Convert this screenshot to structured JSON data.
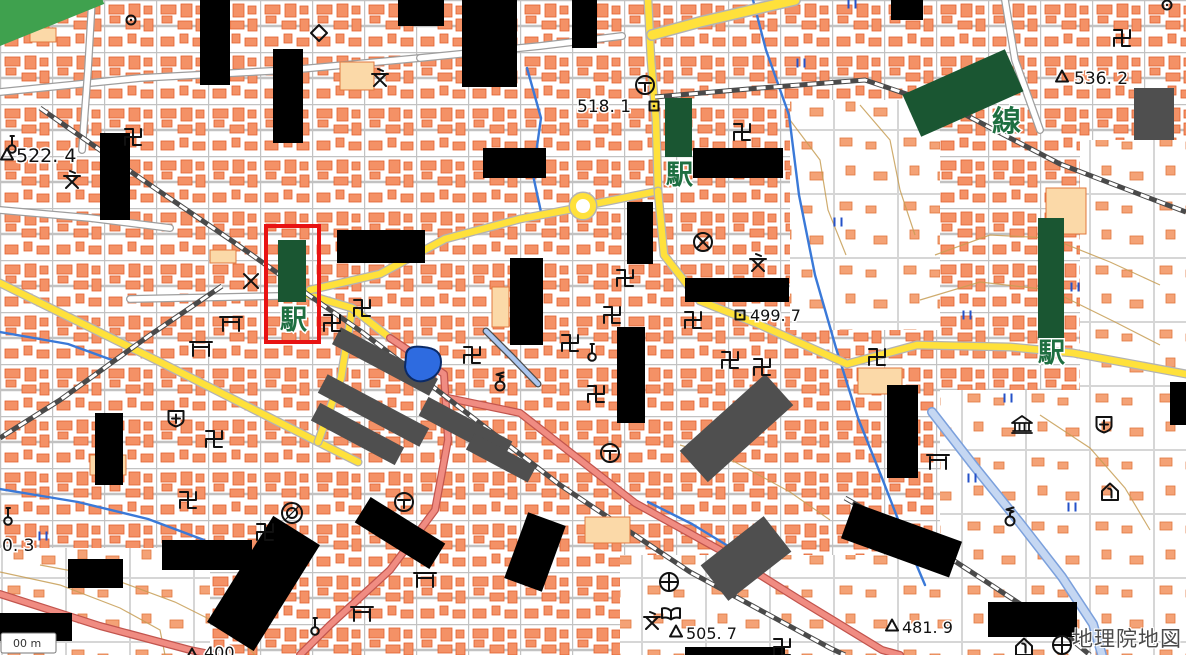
{
  "app": {
    "watermark": "地理院地図",
    "scalebar_text": "00 m"
  },
  "colors": {
    "building": "#f49166",
    "building_edge": "#e2602e",
    "pale_building": "#fbd9a8",
    "yellow_road": "#ffe13b",
    "national_route": "#f08c82",
    "water": "#3a79d8",
    "redaction": "#000000",
    "station_green": "#1a5632",
    "highlight_red": "#e81313"
  },
  "map": {
    "underlays": [
      {
        "x": 940,
        "y": 390,
        "w": 246,
        "h": 265
      },
      {
        "x": 620,
        "y": 555,
        "w": 330,
        "h": 100
      },
      {
        "x": 1080,
        "y": 140,
        "w": 106,
        "h": 250
      },
      {
        "x": 0,
        "y": 548,
        "w": 210,
        "h": 107
      },
      {
        "x": 790,
        "y": 100,
        "w": 150,
        "h": 230
      }
    ],
    "paths": [
      {
        "cls": "contour",
        "pts": "935,255 990,235 1050,238 1110,262 1160,285"
      },
      {
        "cls": "contour",
        "pts": "920,300 980,282 1050,290 1115,322 1160,345"
      },
      {
        "cls": "contour",
        "pts": "40,565 110,578 175,602 235,632 255,655"
      },
      {
        "cls": "contour",
        "pts": "0,572 60,585 120,608 160,630 165,655"
      },
      {
        "cls": "contour",
        "pts": "680,445 735,462 790,492 830,520"
      },
      {
        "cls": "contour",
        "pts": "1040,415 1090,448 1125,488 1150,530"
      },
      {
        "cls": "contour",
        "pts": "790,120 820,160 828,210 846,255"
      },
      {
        "cls": "contour",
        "pts": "860,105 890,140 900,190 915,235"
      },
      {
        "cls": "wroad",
        "pts": "0,92 140,78 290,70 420,58"
      },
      {
        "cls": "wroad",
        "pts": "92,0 88,70 82,150"
      },
      {
        "cls": "wroad",
        "pts": "420,58 540,46 622,36"
      },
      {
        "cls": "wroad",
        "pts": "130,299 280,296"
      },
      {
        "cls": "wroad",
        "pts": "0,210 90,218 170,228"
      },
      {
        "cls": "wroad",
        "pts": "1005,0 1015,60 1040,130"
      },
      {
        "cls": "stream",
        "pts": "753,0 766,50 789,115 799,195 815,275 836,348 858,418 882,478 906,540 925,585"
      },
      {
        "cls": "stream",
        "pts": "527,68 541,118 533,175 541,212"
      },
      {
        "cls": "stream",
        "pts": "0,332 68,344 112,360"
      },
      {
        "cls": "stream",
        "pts": "0,489 78,502 148,519 204,540"
      },
      {
        "cls": "stream",
        "pts": "648,502 692,524 733,549 762,568"
      },
      {
        "cls": "canal",
        "pts": "486,331 512,357 538,384"
      },
      {
        "cls": "riverw",
        "pts": "932,412 974,466 1020,523 1062,577 1093,624 1102,655"
      },
      {
        "cls": "yellow",
        "pts": "0,283 160,362 318,442 358,462"
      },
      {
        "cls": "yellow",
        "pts": "352,310 341,378 318,442"
      },
      {
        "cls": "yellow",
        "pts": "308,295 352,308 390,338"
      },
      {
        "cls": "yellow",
        "pts": "310,290 380,274 445,239 520,219 572,209"
      },
      {
        "cls": "yellow",
        "pts": "594,204 658,191"
      },
      {
        "cls": "yellow",
        "pts": "648,0 651,60 656,120 658,191"
      },
      {
        "cls": "yellow",
        "pts": "658,191 664,255 700,301 758,324 847,364 917,345 1010,347 1073,353 1186,374"
      },
      {
        "cls": "yellowwide",
        "pts": "652,35 700,22 795,0"
      },
      {
        "cls": "pink",
        "pts": "390,338 444,374 448,440 435,510 390,570 330,625 300,655"
      },
      {
        "cls": "pink",
        "pts": "448,398 520,413 580,460 635,503 720,550 800,600 882,650 900,655"
      },
      {
        "cls": "pink",
        "pts": "0,594 100,626 190,650 215,655"
      },
      {
        "cls": "rail",
        "pts": "40,108 140,178 235,243 320,303 362,332"
      },
      {
        "cls": "rail",
        "pts": "222,286 150,335 60,400 0,438"
      },
      {
        "cls": "rail",
        "pts": "655,97 760,88 865,80 960,112 1060,164 1186,212"
      },
      {
        "cls": "rail",
        "pts": "362,332 450,400 560,485 690,572 830,648 845,655"
      },
      {
        "cls": "rail",
        "pts": "845,498 950,558 1060,630 1090,655"
      },
      {
        "cls": "stripe",
        "pts": "0,26 78,-6"
      }
    ],
    "pale_buildings": [
      {
        "x": 340,
        "y": 62,
        "w": 34,
        "h": 28
      },
      {
        "x": 1046,
        "y": 188,
        "w": 40,
        "h": 46
      },
      {
        "x": 858,
        "y": 368,
        "w": 44,
        "h": 26
      },
      {
        "x": 585,
        "y": 517,
        "w": 45,
        "h": 26
      },
      {
        "x": 30,
        "y": 28,
        "w": 26,
        "h": 14
      },
      {
        "x": 90,
        "y": 455,
        "w": 36,
        "h": 20
      },
      {
        "x": 210,
        "y": 250,
        "w": 26,
        "h": 13
      },
      {
        "x": 492,
        "y": 287,
        "w": 17,
        "h": 40
      }
    ],
    "gray_boxes": [
      {
        "x": 330,
        "y": 352,
        "w": 110,
        "h": 19,
        "r": 28
      },
      {
        "x": 316,
        "y": 400,
        "w": 115,
        "h": 21,
        "r": 28
      },
      {
        "x": 310,
        "y": 424,
        "w": 95,
        "h": 20,
        "r": 28
      },
      {
        "x": 418,
        "y": 418,
        "w": 95,
        "h": 21,
        "r": 28
      },
      {
        "x": 466,
        "y": 449,
        "w": 70,
        "h": 18,
        "r": 28
      },
      {
        "x": 679,
        "y": 407,
        "w": 115,
        "h": 42,
        "r": -42
      },
      {
        "x": 706,
        "y": 536,
        "w": 80,
        "h": 45,
        "r": -38
      },
      {
        "x": 1134,
        "y": 88,
        "w": 40,
        "h": 52,
        "r": 0
      }
    ],
    "black_boxes": [
      {
        "x": 200,
        "y": 0,
        "w": 30,
        "h": 85
      },
      {
        "x": 273,
        "y": 49,
        "w": 30,
        "h": 94
      },
      {
        "x": 100,
        "y": 133,
        "w": 30,
        "h": 87
      },
      {
        "x": 398,
        "y": 0,
        "w": 46,
        "h": 26
      },
      {
        "x": 462,
        "y": 0,
        "w": 55,
        "h": 87
      },
      {
        "x": 572,
        "y": 0,
        "w": 25,
        "h": 48
      },
      {
        "x": 483,
        "y": 148,
        "w": 63,
        "h": 30
      },
      {
        "x": 693,
        "y": 148,
        "w": 90,
        "h": 30
      },
      {
        "x": 337,
        "y": 230,
        "w": 88,
        "h": 33
      },
      {
        "x": 510,
        "y": 258,
        "w": 33,
        "h": 87
      },
      {
        "x": 627,
        "y": 202,
        "w": 26,
        "h": 62
      },
      {
        "x": 617,
        "y": 327,
        "w": 28,
        "h": 96
      },
      {
        "x": 685,
        "y": 278,
        "w": 104,
        "h": 24
      },
      {
        "x": 887,
        "y": 385,
        "w": 31,
        "h": 93
      },
      {
        "x": 95,
        "y": 413,
        "w": 28,
        "h": 72
      },
      {
        "x": 162,
        "y": 540,
        "w": 90,
        "h": 30
      },
      {
        "x": 68,
        "y": 559,
        "w": 55,
        "h": 29
      },
      {
        "x": 0,
        "y": 613,
        "w": 72,
        "h": 28
      },
      {
        "x": 891,
        "y": 0,
        "w": 32,
        "h": 20
      },
      {
        "x": 1170,
        "y": 382,
        "w": 16,
        "h": 43
      },
      {
        "x": 685,
        "y": 647,
        "w": 100,
        "h": 8
      },
      {
        "x": 988,
        "y": 602,
        "w": 89,
        "h": 35
      },
      {
        "x": 356,
        "y": 518,
        "w": 88,
        "h": 30,
        "r": 32
      },
      {
        "x": 236,
        "y": 521,
        "w": 55,
        "h": 125,
        "r": 32
      },
      {
        "x": 515,
        "y": 517,
        "w": 40,
        "h": 70,
        "r": 20
      },
      {
        "x": 844,
        "y": 521,
        "w": 115,
        "h": 38,
        "r": 20
      }
    ],
    "green_boxes": [
      {
        "x": 278,
        "y": 240,
        "w": 28,
        "h": 62
      },
      {
        "x": 665,
        "y": 98,
        "w": 27,
        "h": 59
      },
      {
        "x": 1038,
        "y": 218,
        "w": 26,
        "h": 122
      },
      {
        "x": 907,
        "y": 70,
        "w": 112,
        "h": 46,
        "r": -24
      }
    ],
    "green_band": {
      "x": -30,
      "y": -18,
      "w": 130,
      "h": 48,
      "r": -22
    },
    "red_box": {
      "x": 266,
      "y": 226,
      "w": 53,
      "h": 116
    },
    "pond_path": "M406,356 C406,346 416,346 423,347 C436,348 441,353 441,362 C441,373 433,379 424,381 C414,383 406,376 405,367 Z",
    "roundabout": {
      "x": 583,
      "y": 206,
      "r": 10
    },
    "scalebar": {
      "x": 1,
      "y": 633,
      "w": 55,
      "h": 20
    },
    "symbols": [
      {
        "t": "temple",
        "x": 133,
        "y": 137
      },
      {
        "t": "temple",
        "x": 742,
        "y": 132
      },
      {
        "t": "temple",
        "x": 362,
        "y": 308
      },
      {
        "t": "temple",
        "x": 332,
        "y": 323
      },
      {
        "t": "temple",
        "x": 472,
        "y": 355
      },
      {
        "t": "temple",
        "x": 570,
        "y": 343
      },
      {
        "t": "temple",
        "x": 877,
        "y": 357
      },
      {
        "t": "temple",
        "x": 214,
        "y": 439
      },
      {
        "t": "temple",
        "x": 625,
        "y": 278
      },
      {
        "t": "temple",
        "x": 612,
        "y": 315
      },
      {
        "t": "temple",
        "x": 693,
        "y": 320
      },
      {
        "t": "temple",
        "x": 730,
        "y": 360
      },
      {
        "t": "temple",
        "x": 762,
        "y": 367
      },
      {
        "t": "temple",
        "x": 596,
        "y": 394
      },
      {
        "t": "temple",
        "x": 188,
        "y": 500
      },
      {
        "t": "temple",
        "x": 265,
        "y": 532
      },
      {
        "t": "temple",
        "x": 782,
        "y": 647
      },
      {
        "t": "temple",
        "x": 1122,
        "y": 38
      },
      {
        "t": "torii",
        "x": 231,
        "y": 322
      },
      {
        "t": "torii",
        "x": 201,
        "y": 347
      },
      {
        "t": "torii",
        "x": 362,
        "y": 612
      },
      {
        "t": "torii",
        "x": 938,
        "y": 460
      },
      {
        "t": "torii",
        "x": 425,
        "y": 578
      },
      {
        "t": "school",
        "x": 72,
        "y": 180
      },
      {
        "t": "school",
        "x": 380,
        "y": 78
      },
      {
        "t": "school",
        "x": 758,
        "y": 263
      },
      {
        "t": "school",
        "x": 652,
        "y": 621
      },
      {
        "t": "police_x",
        "x": 251,
        "y": 281
      },
      {
        "t": "police_o",
        "x": 703,
        "y": 242
      },
      {
        "t": "cityhall",
        "x": 645,
        "y": 85
      },
      {
        "t": "cityhall",
        "x": 404,
        "y": 502
      },
      {
        "t": "cityhall",
        "x": 610,
        "y": 453
      },
      {
        "t": "benchmark",
        "x": 654,
        "y": 106
      },
      {
        "t": "benchmark",
        "x": 740,
        "y": 315
      },
      {
        "t": "triang",
        "x": 7,
        "y": 155
      },
      {
        "t": "triang",
        "x": 1062,
        "y": 77
      },
      {
        "t": "triang",
        "x": 676,
        "y": 632
      },
      {
        "t": "triang",
        "x": 892,
        "y": 626
      },
      {
        "t": "triang",
        "x": 192,
        "y": 655
      },
      {
        "t": "hospital",
        "x": 176,
        "y": 418
      },
      {
        "t": "hospital",
        "x": 1104,
        "y": 424
      },
      {
        "t": "health",
        "x": 669,
        "y": 582
      },
      {
        "t": "health",
        "x": 1062,
        "y": 645
      },
      {
        "t": "library",
        "x": 671,
        "y": 613
      },
      {
        "t": "museum",
        "x": 1022,
        "y": 425
      },
      {
        "t": "home",
        "x": 1110,
        "y": 492
      },
      {
        "t": "home",
        "x": 1024,
        "y": 647
      },
      {
        "t": "castle",
        "x": 319,
        "y": 33
      },
      {
        "t": "well",
        "x": 1010,
        "y": 517
      },
      {
        "t": "well",
        "x": 500,
        "y": 382
      },
      {
        "t": "monument",
        "x": 315,
        "y": 626
      },
      {
        "t": "monument",
        "x": 8,
        "y": 516
      },
      {
        "t": "monument",
        "x": 592,
        "y": 352
      },
      {
        "t": "monument",
        "x": 12,
        "y": 144
      },
      {
        "t": "dblcirc",
        "x": 292,
        "y": 513
      },
      {
        "t": "dotcirc",
        "x": 131,
        "y": 20
      },
      {
        "t": "dotcirc",
        "x": 1167,
        "y": 5
      },
      {
        "t": "paddy",
        "x": 852,
        "y": 4
      },
      {
        "t": "paddy",
        "x": 838,
        "y": 222
      },
      {
        "t": "paddy",
        "x": 1075,
        "y": 287
      },
      {
        "t": "paddy",
        "x": 967,
        "y": 315
      },
      {
        "t": "paddy",
        "x": 1008,
        "y": 398
      },
      {
        "t": "paddy",
        "x": 972,
        "y": 478
      },
      {
        "t": "paddy",
        "x": 1072,
        "y": 507
      },
      {
        "t": "paddy",
        "x": 43,
        "y": 536
      },
      {
        "t": "paddy",
        "x": 801,
        "y": 63
      }
    ],
    "labels": [
      {
        "text": "522. 4",
        "x": 16,
        "y": 162,
        "s": 19
      },
      {
        "text": "518. 1",
        "x": 577,
        "y": 112,
        "s": 17
      },
      {
        "text": "536. 2",
        "x": 1074,
        "y": 84,
        "s": 17
      },
      {
        "text": "499. 7",
        "x": 750,
        "y": 321,
        "s": 16
      },
      {
        "text": "505. 7",
        "x": 686,
        "y": 639,
        "s": 16
      },
      {
        "text": "481. 9",
        "x": 902,
        "y": 633,
        "s": 16
      },
      {
        "text": "0. 3",
        "x": 2,
        "y": 551,
        "s": 17
      },
      {
        "text": "400",
        "x": 204,
        "y": 658,
        "s": 16
      }
    ],
    "green_labels": [
      {
        "text": "駅",
        "x": 280,
        "y": 329,
        "s": 27
      },
      {
        "text": "駅",
        "x": 666,
        "y": 184,
        "s": 27
      },
      {
        "text": "駅",
        "x": 1038,
        "y": 362,
        "s": 27
      },
      {
        "text": "線",
        "x": 992,
        "y": 131,
        "s": 29
      }
    ]
  }
}
